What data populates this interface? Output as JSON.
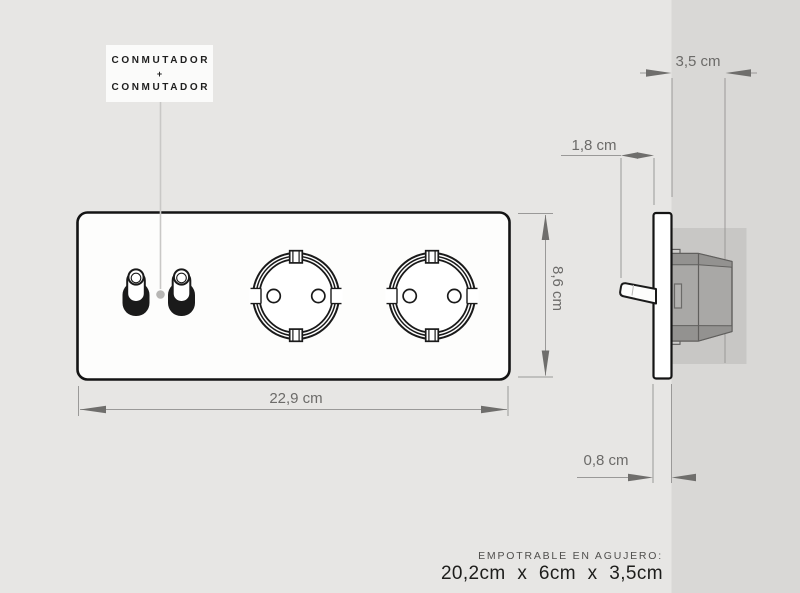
{
  "callout": {
    "line1": "CONMUTADOR",
    "separator": "+",
    "line2": "CONMUTADOR"
  },
  "dimensions": {
    "panel_width": "22,9 cm",
    "panel_height": "8,6 cm",
    "recess_depth": "3,5 cm",
    "lever_protrusion": "1,8 cm",
    "plate_thickness": "0,8 cm"
  },
  "footer": {
    "note": "EMPOTRABLE EN AGUJERO:",
    "hole_size": "20,2cm x 6cm x 3,5cm"
  },
  "colors": {
    "background": "#e7e6e4",
    "wall": "#d9d8d6",
    "recess": "#c8c7c5",
    "mechanism_box": "#a9a8a6",
    "dimension_line": "#9a9998",
    "dimension_arrow": "#6f6e6c",
    "dimension_text": "#6c6b69",
    "ink": "#1a1a1a",
    "label_box": "#fbfbfa",
    "leader": "#c9c8c6"
  }
}
